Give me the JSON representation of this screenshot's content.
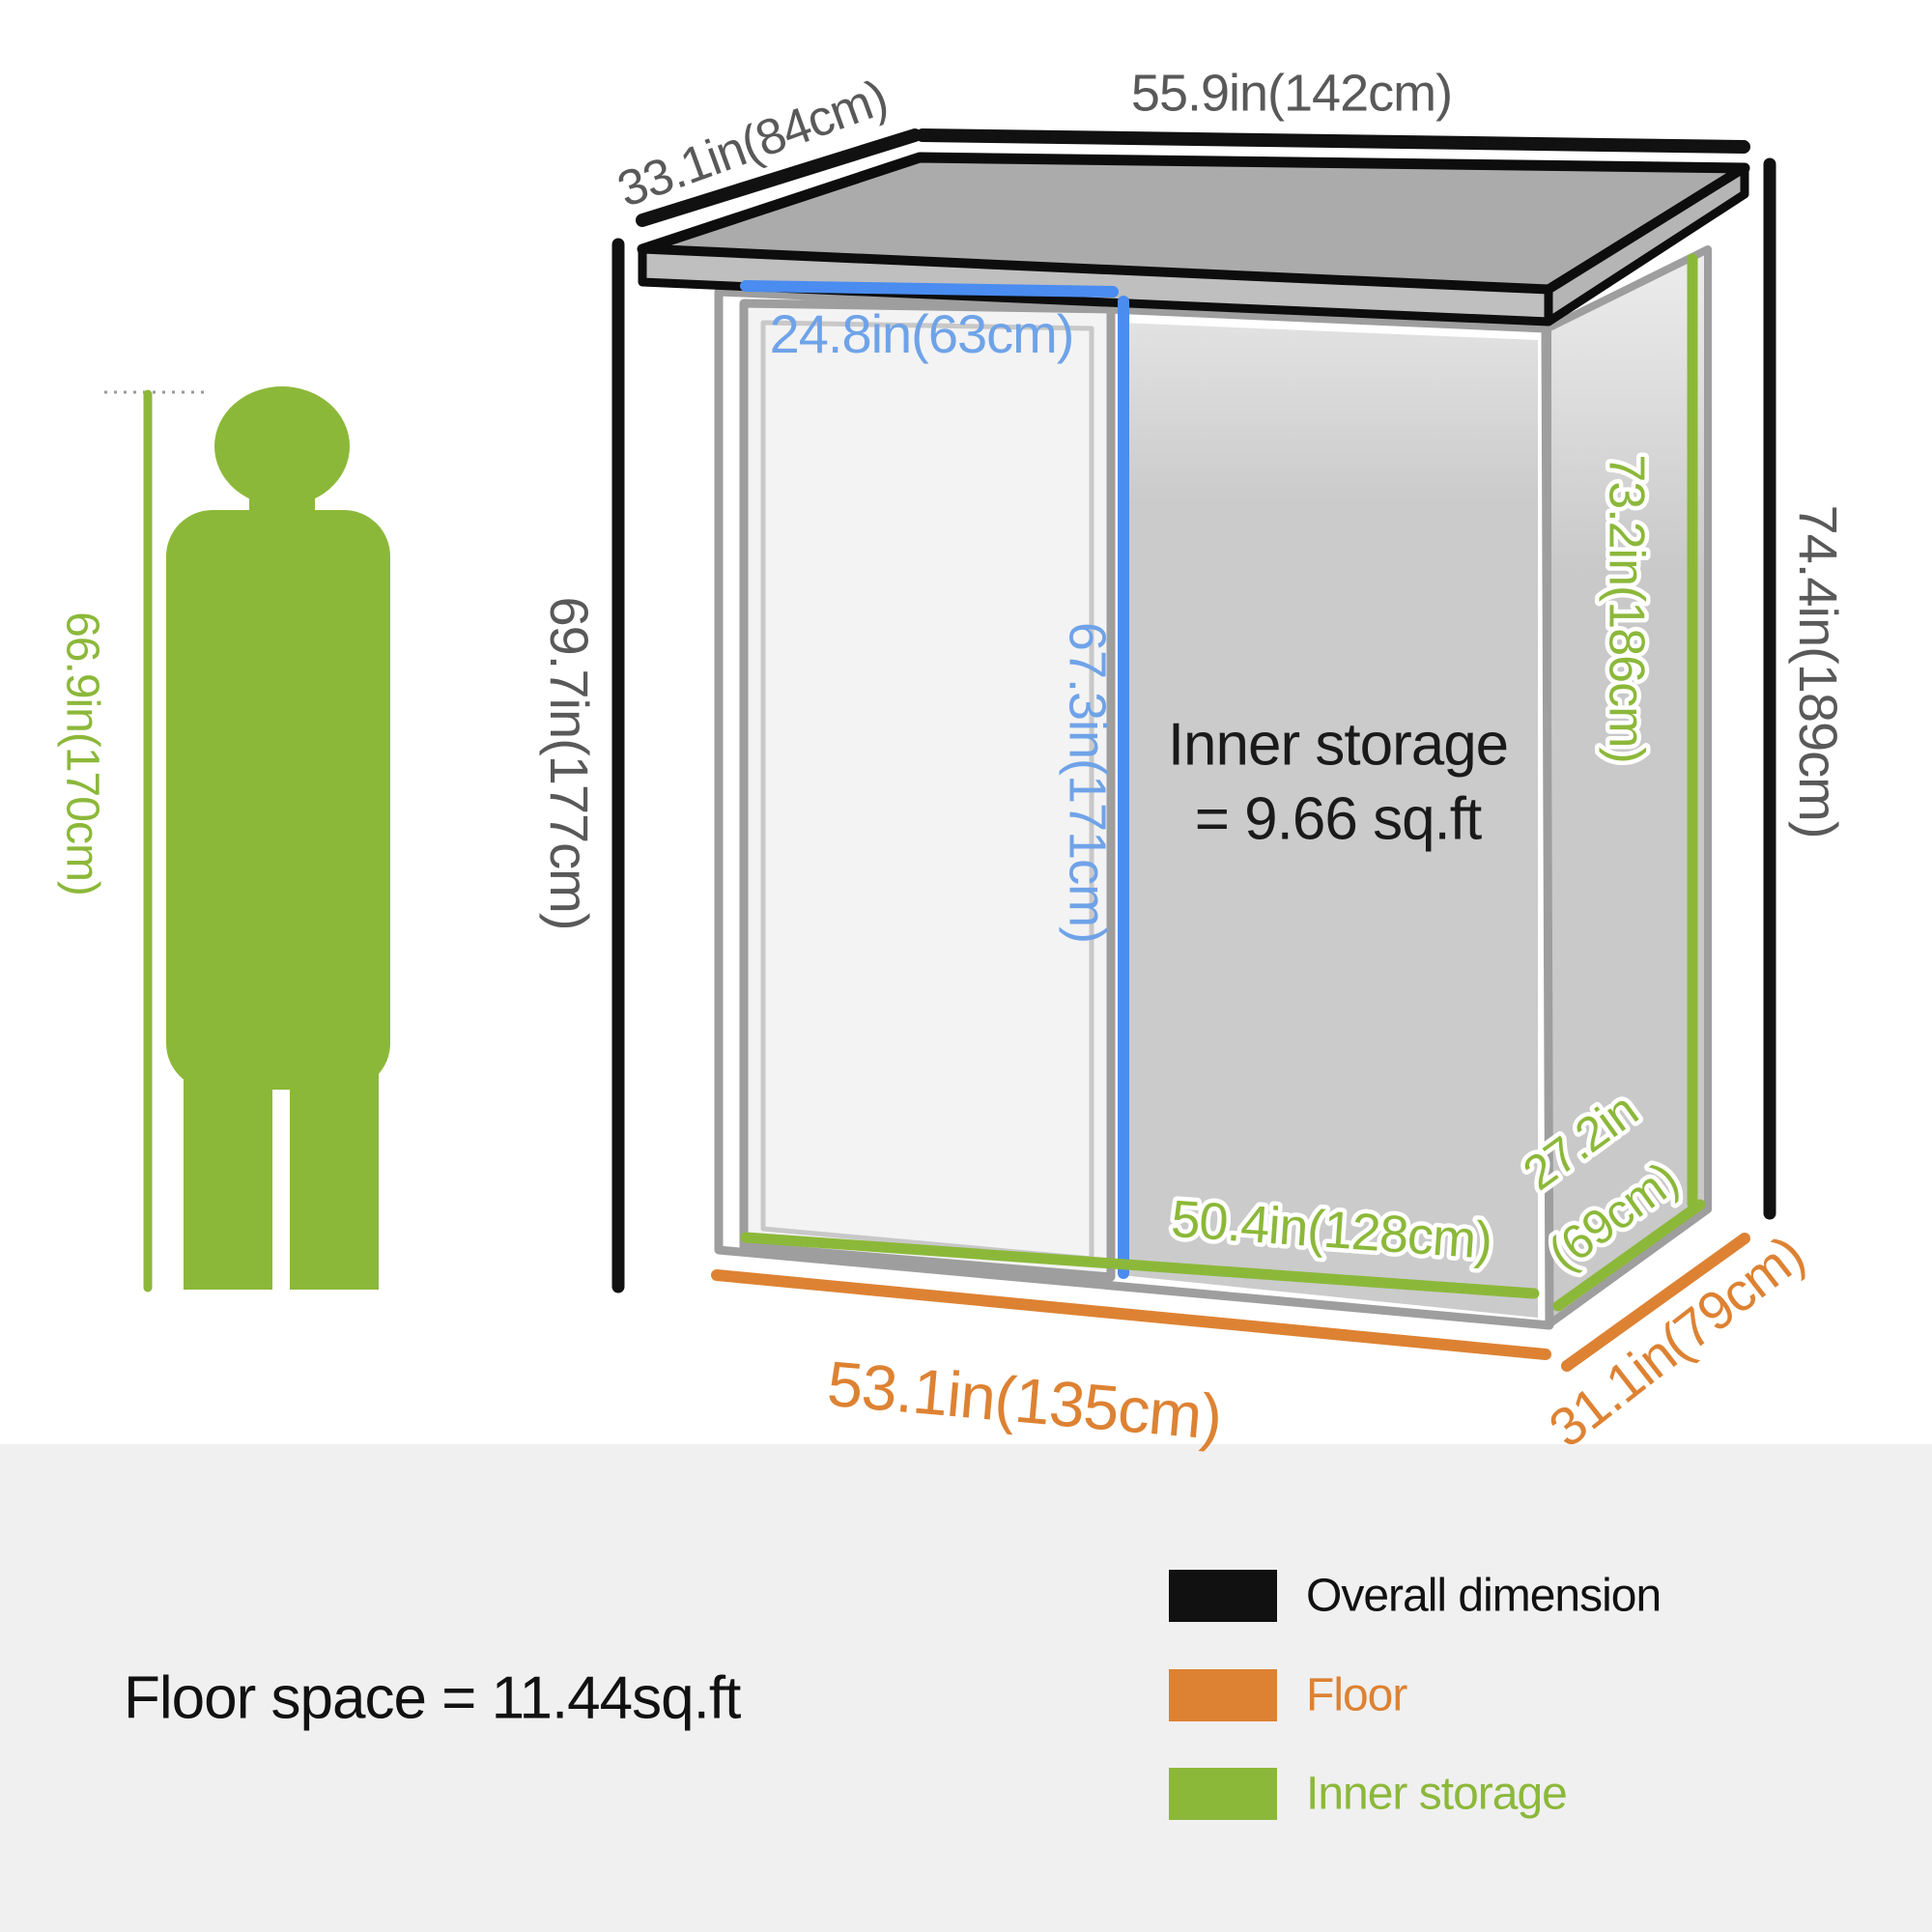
{
  "diagram": {
    "overall": {
      "width": "55.9in(142cm)",
      "depth": "33.1in(84cm)",
      "height_back": "74.4in(189cm)",
      "height_front": "69.7in(177cm)"
    },
    "door": {
      "width": "24.8in(63cm)",
      "height": "67.3in(171cm)"
    },
    "inner": {
      "height": "73.2in(186cm)",
      "width": "50.4in(128cm)",
      "depth_line1": "27.2in",
      "depth_line2": "(69cm)",
      "note_line1": "Inner storage",
      "note_line2": "= 9.66 sq.ft"
    },
    "floor": {
      "width": "53.1in(135cm)",
      "depth": "31.1in(79cm)"
    },
    "person": {
      "height": "66.9in(170cm)"
    }
  },
  "footer": {
    "floor_space": "Floor space = 11.44sq.ft",
    "legend": [
      {
        "label": "Overall dimension",
        "color": "#111111"
      },
      {
        "label": "Floor",
        "color": "#DD8233"
      },
      {
        "label": "Inner storage",
        "color": "#8CB83A"
      }
    ]
  },
  "colors": {
    "green": "#8CB83A",
    "orange": "#DD8233",
    "blue_line": "#4A8CF0",
    "blue_text": "#6FA3E8",
    "dim_text": "#595959",
    "black": "#111111",
    "roof_gray": "#ABABAB",
    "wall_gray": "#CBCBCB",
    "footer_bg": "#F0F0F0"
  }
}
